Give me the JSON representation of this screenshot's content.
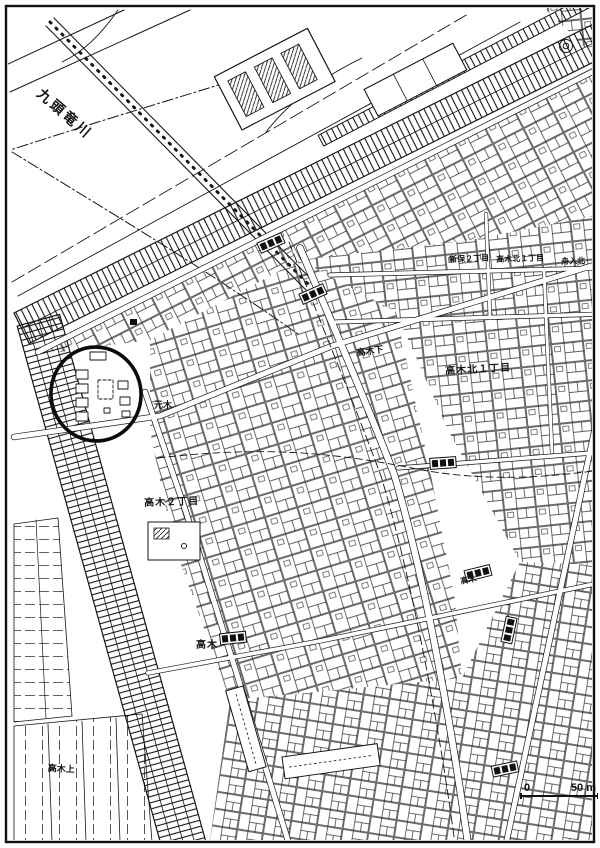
{
  "page": {
    "paper_color": "#ffffff",
    "ink_color": "#161616"
  },
  "map_kind": "scanned cadastral city map",
  "labels": [
    {
      "text": "九頭竜川",
      "x": 44,
      "y": 86,
      "rot": 41,
      "size": 14,
      "ls": 3
    },
    {
      "text": "新保２丁目",
      "x": 449,
      "y": 256,
      "rot": -2,
      "size": 8,
      "ls": 0
    },
    {
      "text": "高木北１丁目",
      "x": 496,
      "y": 256,
      "rot": -2,
      "size": 8,
      "ls": 0
    },
    {
      "text": "舟入北",
      "x": 561,
      "y": 258,
      "rot": -2,
      "size": 8,
      "ls": 0
    },
    {
      "text": "高木北１丁目",
      "x": 445,
      "y": 367,
      "rot": -3,
      "size": 10,
      "ls": 1
    },
    {
      "text": "高木２丁目",
      "x": 144,
      "y": 499,
      "rot": -2,
      "size": 10,
      "ls": 1
    },
    {
      "text": "高木",
      "x": 196,
      "y": 641,
      "rot": 0,
      "size": 10,
      "ls": 1
    },
    {
      "text": "元木",
      "x": 154,
      "y": 401,
      "rot": 0,
      "size": 9,
      "ls": 0
    },
    {
      "text": "高木下",
      "x": 356,
      "y": 349,
      "rot": -8,
      "size": 9,
      "ls": 0
    },
    {
      "text": "高木上",
      "x": 48,
      "y": 764,
      "rot": 3,
      "size": 9,
      "ls": 0
    },
    {
      "text": "高木",
      "x": 460,
      "y": 578,
      "rot": -10,
      "size": 8,
      "ls": 0
    }
  ],
  "scale_bar": {
    "zero": "0",
    "distance": "50 m"
  }
}
